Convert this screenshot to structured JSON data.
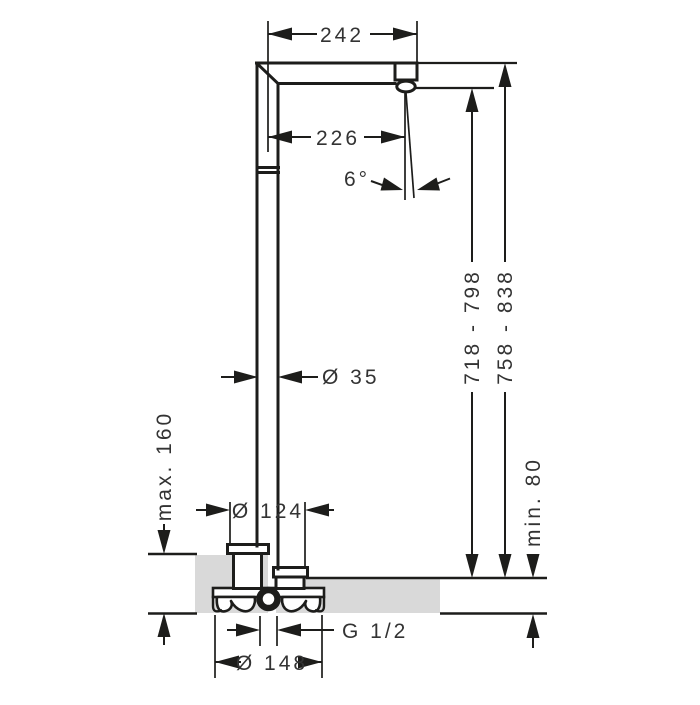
{
  "labels": {
    "spout_reach": "242",
    "outlet_reach": "226",
    "spray_angle": "6°",
    "riser_diameter": "Ø 35",
    "outlet_height": "718 - 798",
    "overall_height": "758 - 838",
    "max_floor_buildup": "max. 160",
    "base_diameter": "Ø 124",
    "min_floor_buildup": "min. 80",
    "connection_thread": "G 1/2",
    "rough_in_diameter": "Ø 148"
  },
  "colors": {
    "line": "#1d1d1b",
    "text": "#333333",
    "floor": "#d9d9d9",
    "background": "#ffffff"
  }
}
